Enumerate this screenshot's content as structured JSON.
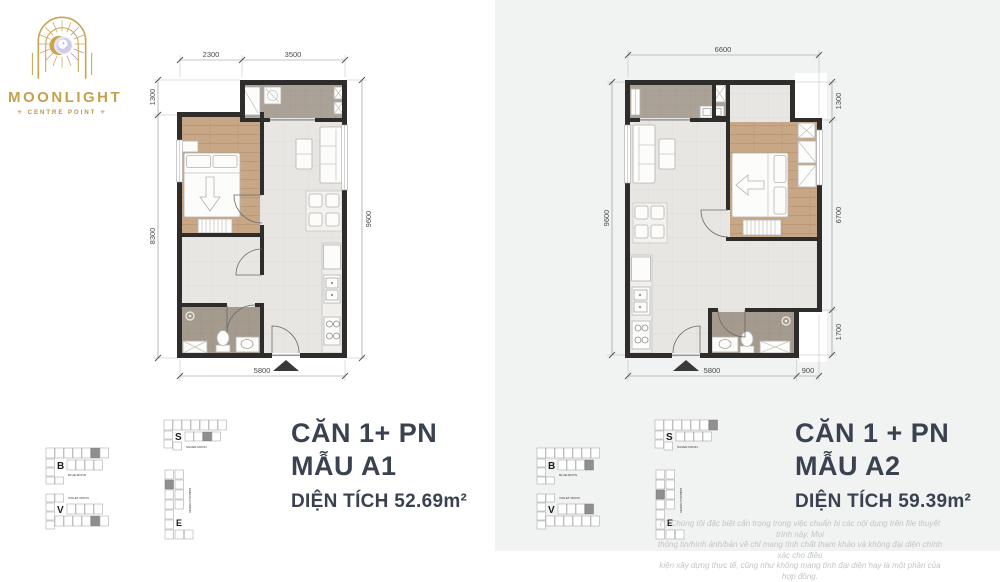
{
  "logo": {
    "title": "MOONLIGHT",
    "subtitle": "✳ CENTRE POINT ✳"
  },
  "plan_a1": {
    "title_line1": "CĂN 1+ PN",
    "title_line2": "MẪU A1",
    "area": "DIỆN TÍCH 52.69m²",
    "dim_top_left": "2300",
    "dim_top_right": "3500",
    "dim_left_top": "1300",
    "dim_left_bottom": "8300",
    "dim_right": "9600",
    "dim_bottom": "5800"
  },
  "plan_a2": {
    "title_line1": "CĂN 1 + PN",
    "title_line2": "MẪU A2",
    "area": "DIỆN TÍCH 59.39m²",
    "dim_top": "6600",
    "dim_right_top": "1300",
    "dim_right_mid": "6700",
    "dim_right_bottom": "1700",
    "dim_left": "9600",
    "dim_bottom_main": "5800",
    "dim_bottom_right": "900"
  },
  "keyplans": {
    "b": {
      "letter": "B",
      "name": "BLUE MOON"
    },
    "v": {
      "letter": "V",
      "name": "VIOLET MOON"
    },
    "s": {
      "letter": "S",
      "name": "SILVER MOON"
    },
    "e": {
      "letter": "E",
      "name": "EMERALD MOON"
    }
  },
  "disclaimer": {
    "line1": "(*) Chúng tôi đặc biệt cẩn trọng trong việc chuẩn bị các nội dung trên file thuyết trình này. Mọi",
    "line2": "thông tin/hình ảnh/bản vẽ chỉ mang tính chất tham khảo và không đại diện chính xác cho điều",
    "line3": "kiện xây dựng thực tế, cũng như không mang tính đại diện hay là một phần của hợp đồng."
  },
  "colors": {
    "accent_gold": "#c6a14c",
    "title_navy": "#3a4250",
    "wall": "#2e2d2b",
    "panel_bg": "#f1f2f2"
  }
}
